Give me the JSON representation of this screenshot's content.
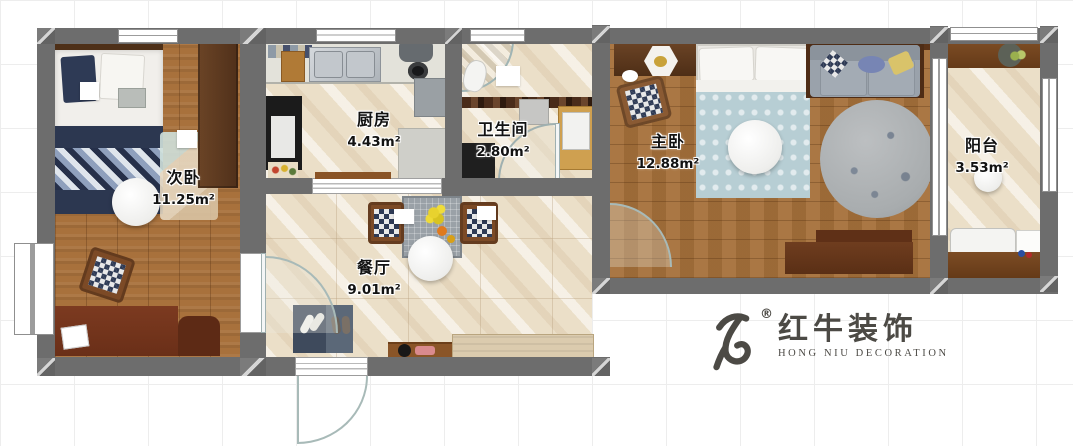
{
  "rooms": [
    {
      "name": "secondary-bedroom",
      "label": "次卧",
      "area": "11.25m²"
    },
    {
      "name": "kitchen",
      "label": "厨房",
      "area": "4.43m²"
    },
    {
      "name": "bathroom",
      "label": "卫生间",
      "area": "2.80m²"
    },
    {
      "name": "master-bedroom",
      "label": "主卧",
      "area": "12.88m²"
    },
    {
      "name": "balcony",
      "label": "阳台",
      "area": "3.53m²"
    },
    {
      "name": "dining-room",
      "label": "餐厅",
      "area": "9.01m²"
    }
  ],
  "logo": {
    "brand_cn": "红牛装饰",
    "brand_en": "HONG NIU DECORATION",
    "registered": "®",
    "color": "#4c4a45"
  },
  "colors": {
    "wall": "#6d6d6d",
    "wood_floor": "#a8713c",
    "tile_floor": "#ebdfc8",
    "duvet_blue": "#b7ced4",
    "navy": "#2c3750",
    "sofa_gray": "#9aa2ab"
  }
}
